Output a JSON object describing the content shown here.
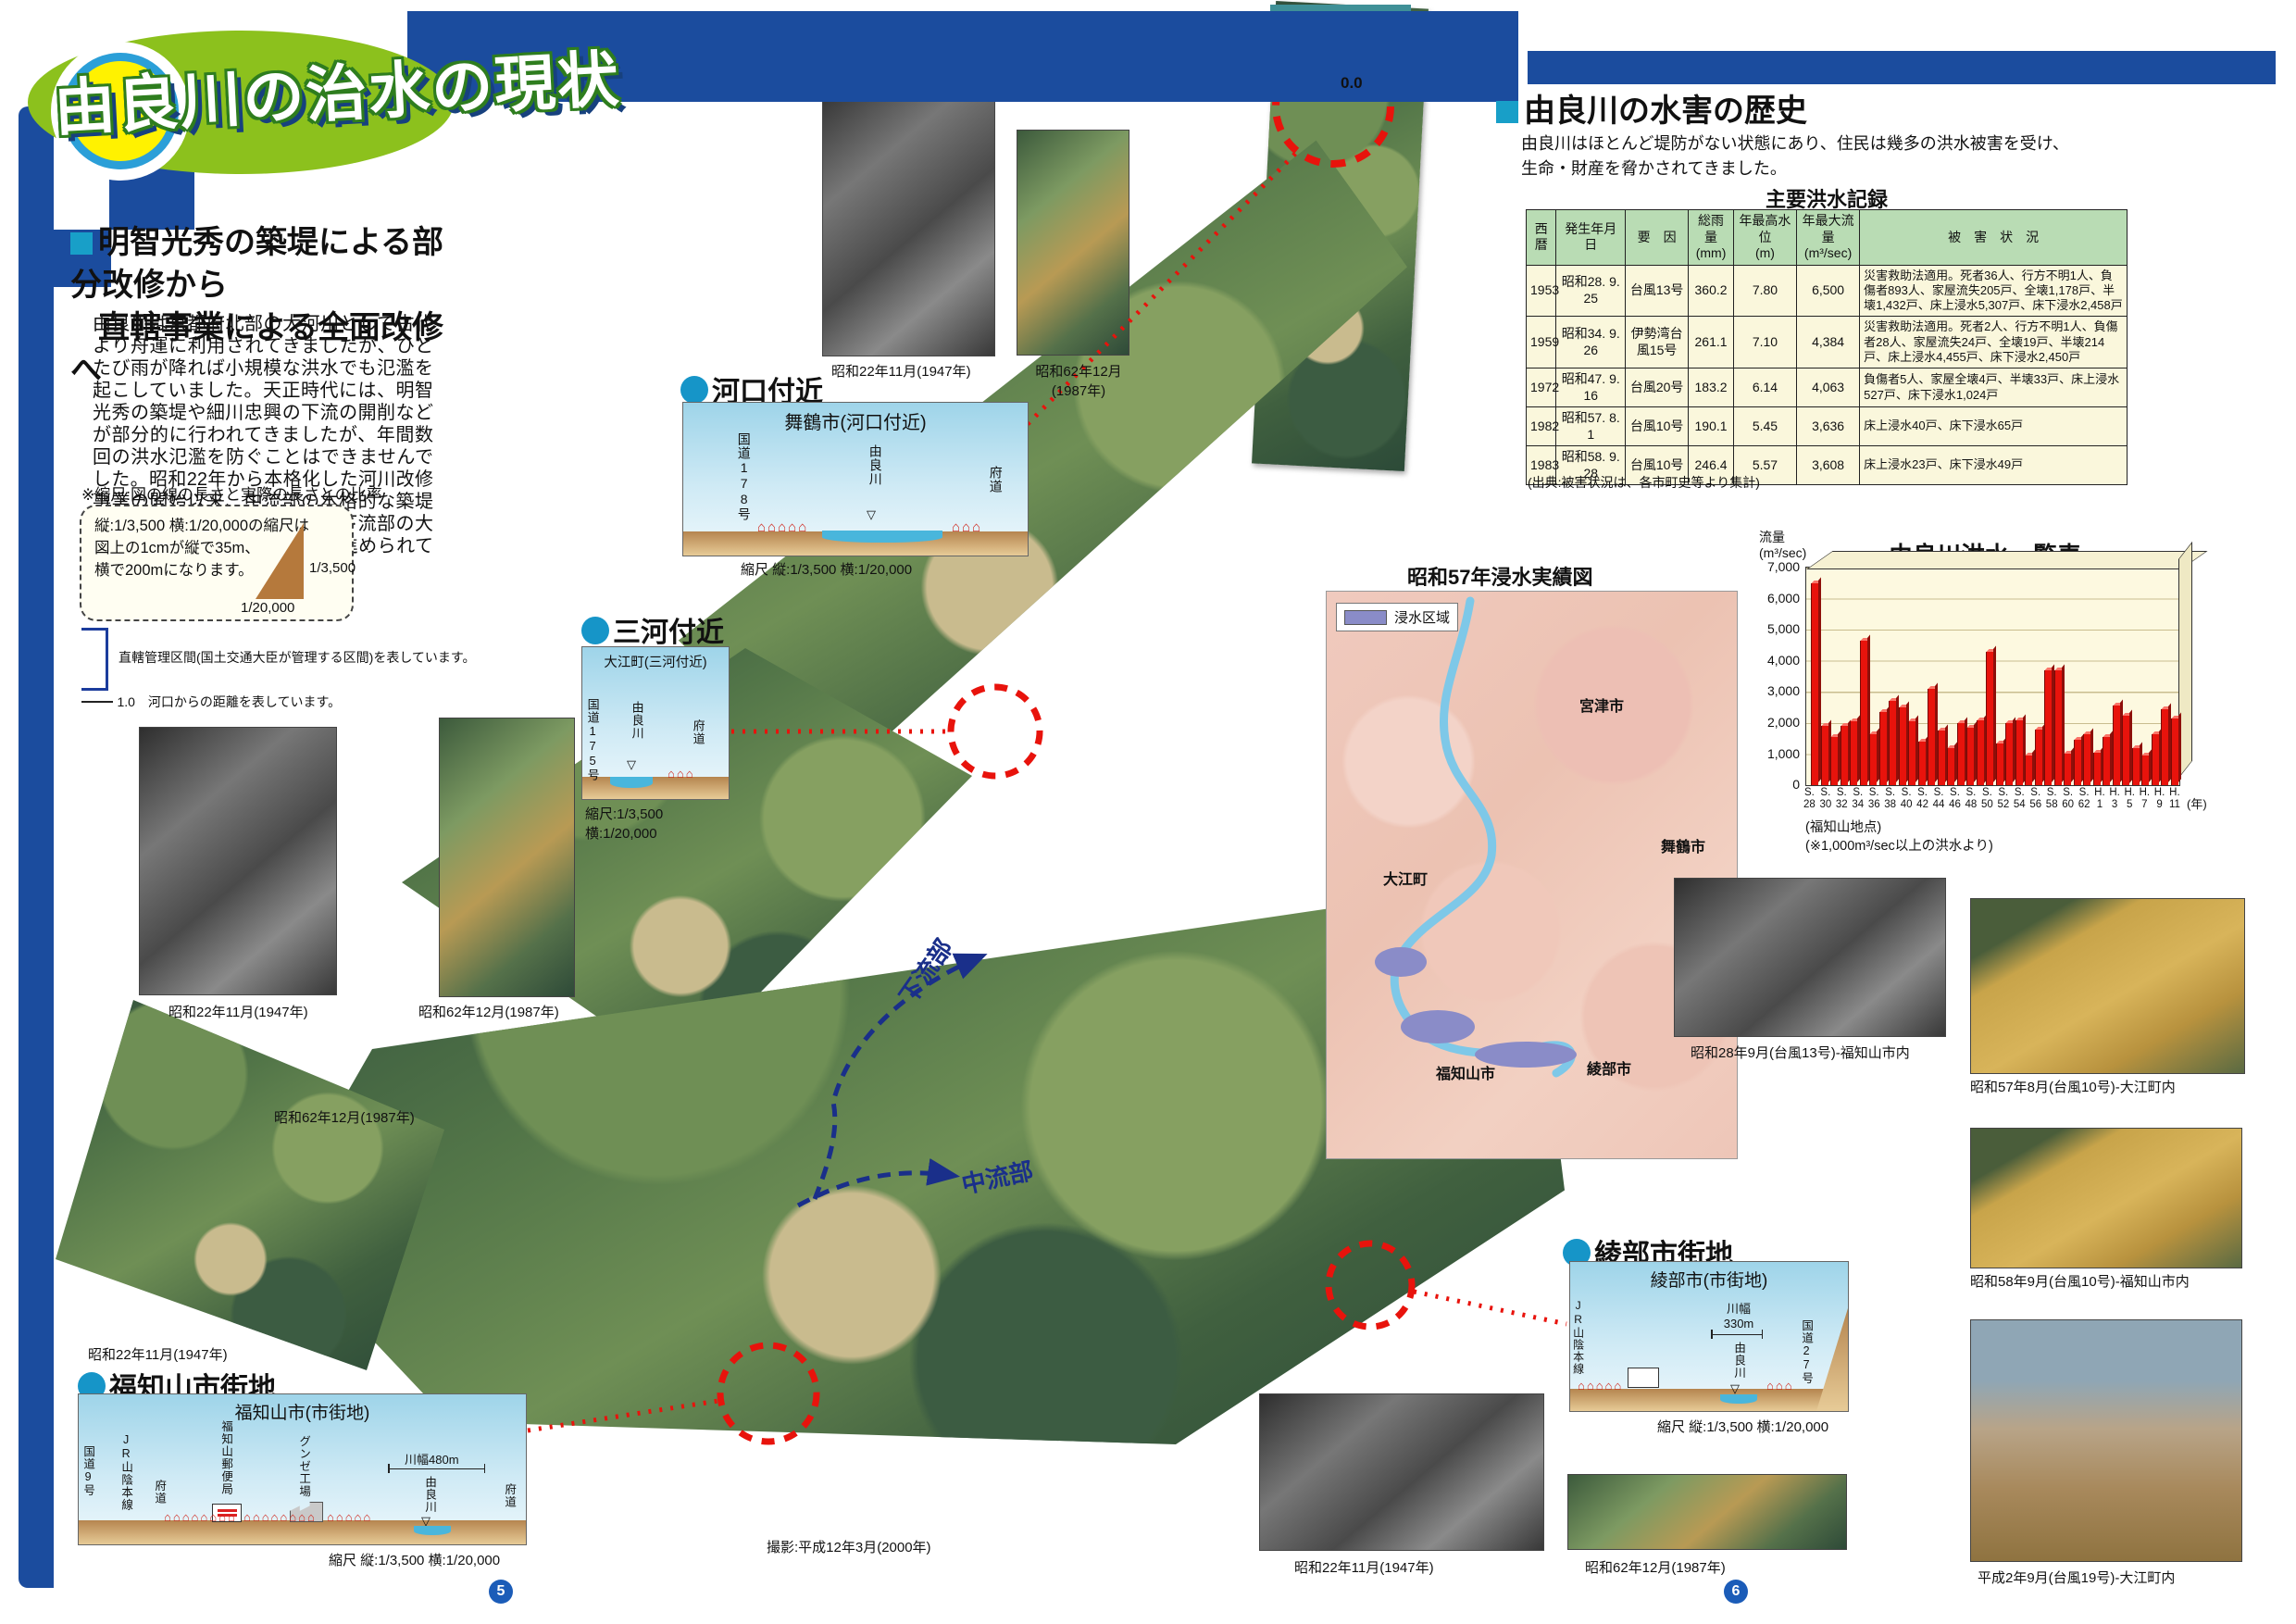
{
  "masthead": {
    "title": "由良川の治水の現状"
  },
  "intro": {
    "heading1": "明智光秀の築堤による部分改修から",
    "heading2": "直轄事業による全面改修へ",
    "body": "由良川は京都府北部の大河川として古代より舟運に利用されてきましたが、ひとたび雨が降れば小規模な洪水でも氾濫を起こしていました。天正時代には、明智光秀の築堤や細川忠興の下流の開削などが部分的に行われてきましたが、年間数回の洪水氾濫を防ぐことはできませんでした。昭和22年から本格化した河川改修事業の開始以来、中流部の本格的な築堤事業、市街地内水排除事業、下流部の大規模な河道拡幅・掘削などが進められてきました。"
  },
  "scale_note": {
    "title": "※縮尺:図の線の長さと実際の長さとの比率",
    "body": "縦:1/3,500 横:1/20,000の縮尺は\n図上の1cmが縦で35m、\n横で200mになります。",
    "tri_v": "1/3,500",
    "tri_h": "1/20,000"
  },
  "legend": {
    "kanri": "直轄管理区間(国土交通大臣が管理する区間)を表しています。",
    "distance": "1.0　河口からの距離を表しています。"
  },
  "map": {
    "cap_1947": "昭和22年11月(1947年)",
    "cap_1987": "昭和62年12月(1987年)",
    "cap_1987_2l": "昭和62年12月\n(1987年)",
    "cap_shoot": "撮影:平成12年3月(2000年)",
    "flow_down": "下流部",
    "flow_mid": "中流部",
    "distance0": "0.0"
  },
  "sections": {
    "kakou": {
      "bullet": "河口付近",
      "title": "舞鶴市(河口付近)",
      "l1": "国道178号",
      "l2": "由良川",
      "l3": "府道",
      "scale": "縮尺 縦:1/3,500 横:1/20,000"
    },
    "mikawa": {
      "bullet": "三河付近",
      "title": "大江町(三河付近)",
      "l1": "国道175号",
      "l2": "由良川",
      "l3": "府道",
      "scale": "縮尺:1/3,500\n横:1/20,000"
    },
    "fukuchiyama": {
      "bullet": "福知山市街地",
      "title": "福知山市(市街地)",
      "l1": "国道9号",
      "l2": "JR山陰本線",
      "l3": "府道",
      "l4": "福知山郵便局",
      "l5": "グンゼ工場",
      "width": "川幅480m",
      "l6": "由良川",
      "l7": "府道",
      "scale": "縮尺 縦:1/3,500 横:1/20,000"
    },
    "ayabe": {
      "bullet": "綾部市街地",
      "title": "綾部市(市街地)",
      "l1": "JR山陰本線",
      "width": "川幅\n330m",
      "l2": "由良川",
      "l3": "国道27号",
      "scale": "縮尺 縦:1/3,500 横:1/20,000"
    }
  },
  "history": {
    "heading": "由良川の水害の歴史",
    "body": "由良川はほとんど堤防がない状態にあり、住民は幾多の洪水被害を受け、\n生命・財産を脅かされてきました。"
  },
  "flood_table": {
    "title": "主要洪水記録",
    "headers": [
      "西暦",
      "発生年月日",
      "要　因",
      "総雨量\n(mm)",
      "年最高水位\n(m)",
      "年最大流量\n(m³/sec)",
      "被　害　状　況"
    ],
    "rows": [
      [
        "1953",
        "昭和28. 9. 25",
        "台風13号",
        "360.2",
        "7.80",
        "6,500",
        "災害救助法適用。死者36人、行方不明1人、負傷者893人、家屋流失205戸、全壊1,178戸、半壊1,432戸、床上浸水5,307戸、床下浸水2,458戸"
      ],
      [
        "1959",
        "昭和34. 9. 26",
        "伊勢湾台風15号",
        "261.1",
        "7.10",
        "4,384",
        "災害救助法適用。死者2人、行方不明1人、負傷者28人、家屋流失24戸、全壊19戸、半壊214戸、床上浸水4,455戸、床下浸水2,450戸"
      ],
      [
        "1972",
        "昭和47. 9. 16",
        "台風20号",
        "183.2",
        "6.14",
        "4,063",
        "負傷者5人、家屋全壊4戸、半壊33戸、床上浸水527戸、床下浸水1,024戸"
      ],
      [
        "1982",
        "昭和57. 8. 1",
        "台風10号",
        "190.1",
        "5.45",
        "3,636",
        "床上浸水40戸、床下浸水65戸"
      ],
      [
        "1983",
        "昭和58. 9. 28",
        "台風10号",
        "246.4",
        "5.57",
        "3,608",
        "床上浸水23戸、床下浸水49戸"
      ]
    ],
    "source": "(出典:被害状況は、各市町史等より集計)"
  },
  "chart_data": {
    "type": "bar",
    "title": "由良川洪水一覧表",
    "ylabel": "流量\n(m³/sec)",
    "ylim": [
      0,
      7000
    ],
    "grid": true,
    "y_ticks": [
      "7,000",
      "6,000",
      "5,000",
      "4,000",
      "3,000",
      "2,000",
      "1,000",
      "0"
    ],
    "x_tick_labels": [
      "S.\n28",
      "S.\n30",
      "S.\n32",
      "S.\n34",
      "S.\n36",
      "S.\n38",
      "S.\n40",
      "S.\n42",
      "S.\n44",
      "S.\n46",
      "S.\n48",
      "S.\n50",
      "S.\n52",
      "S.\n54",
      "S.\n56",
      "S.\n58",
      "S.\n60",
      "S.\n62",
      "H.\n1",
      "H.\n3",
      "H.\n5",
      "H.\n7",
      "H.\n9",
      "H.\n11"
    ],
    "x_axis_unit": "(年)",
    "notes": [
      "(福知山地点)",
      "(※1,000m³/sec以上の洪水より)"
    ],
    "values": [
      6500,
      1900,
      1550,
      1900,
      2050,
      4650,
      1650,
      2350,
      2700,
      2500,
      2050,
      1400,
      3100,
      1750,
      1200,
      2000,
      1850,
      2100,
      4300,
      1350,
      2000,
      2100,
      950,
      1800,
      3700,
      3700,
      1000,
      1450,
      1650,
      1050,
      1550,
      2550,
      2250,
      1200,
      950,
      1650,
      2450,
      2150
    ],
    "bar_color": "#e8130c"
  },
  "flood_map": {
    "title": "昭和57年浸水実績図",
    "legend_label": "浸水区域",
    "cities": {
      "miyazu": "宮津市",
      "maizuru": "舞鶴市",
      "oe": "大江町",
      "fukuchiyama": "福知山市",
      "ayabe": "綾部市"
    }
  },
  "photos": {
    "p_s28": "昭和28年9月(台風13号)-福知山市内",
    "p_s57": "昭和57年8月(台風10号)-大江町内",
    "p_s58": "昭和58年9月(台風10号)-福知山市内",
    "p_h2": "平成2年9月(台風19号)-大江町内"
  },
  "footer": {
    "page_left": "5",
    "page_right": "6"
  }
}
